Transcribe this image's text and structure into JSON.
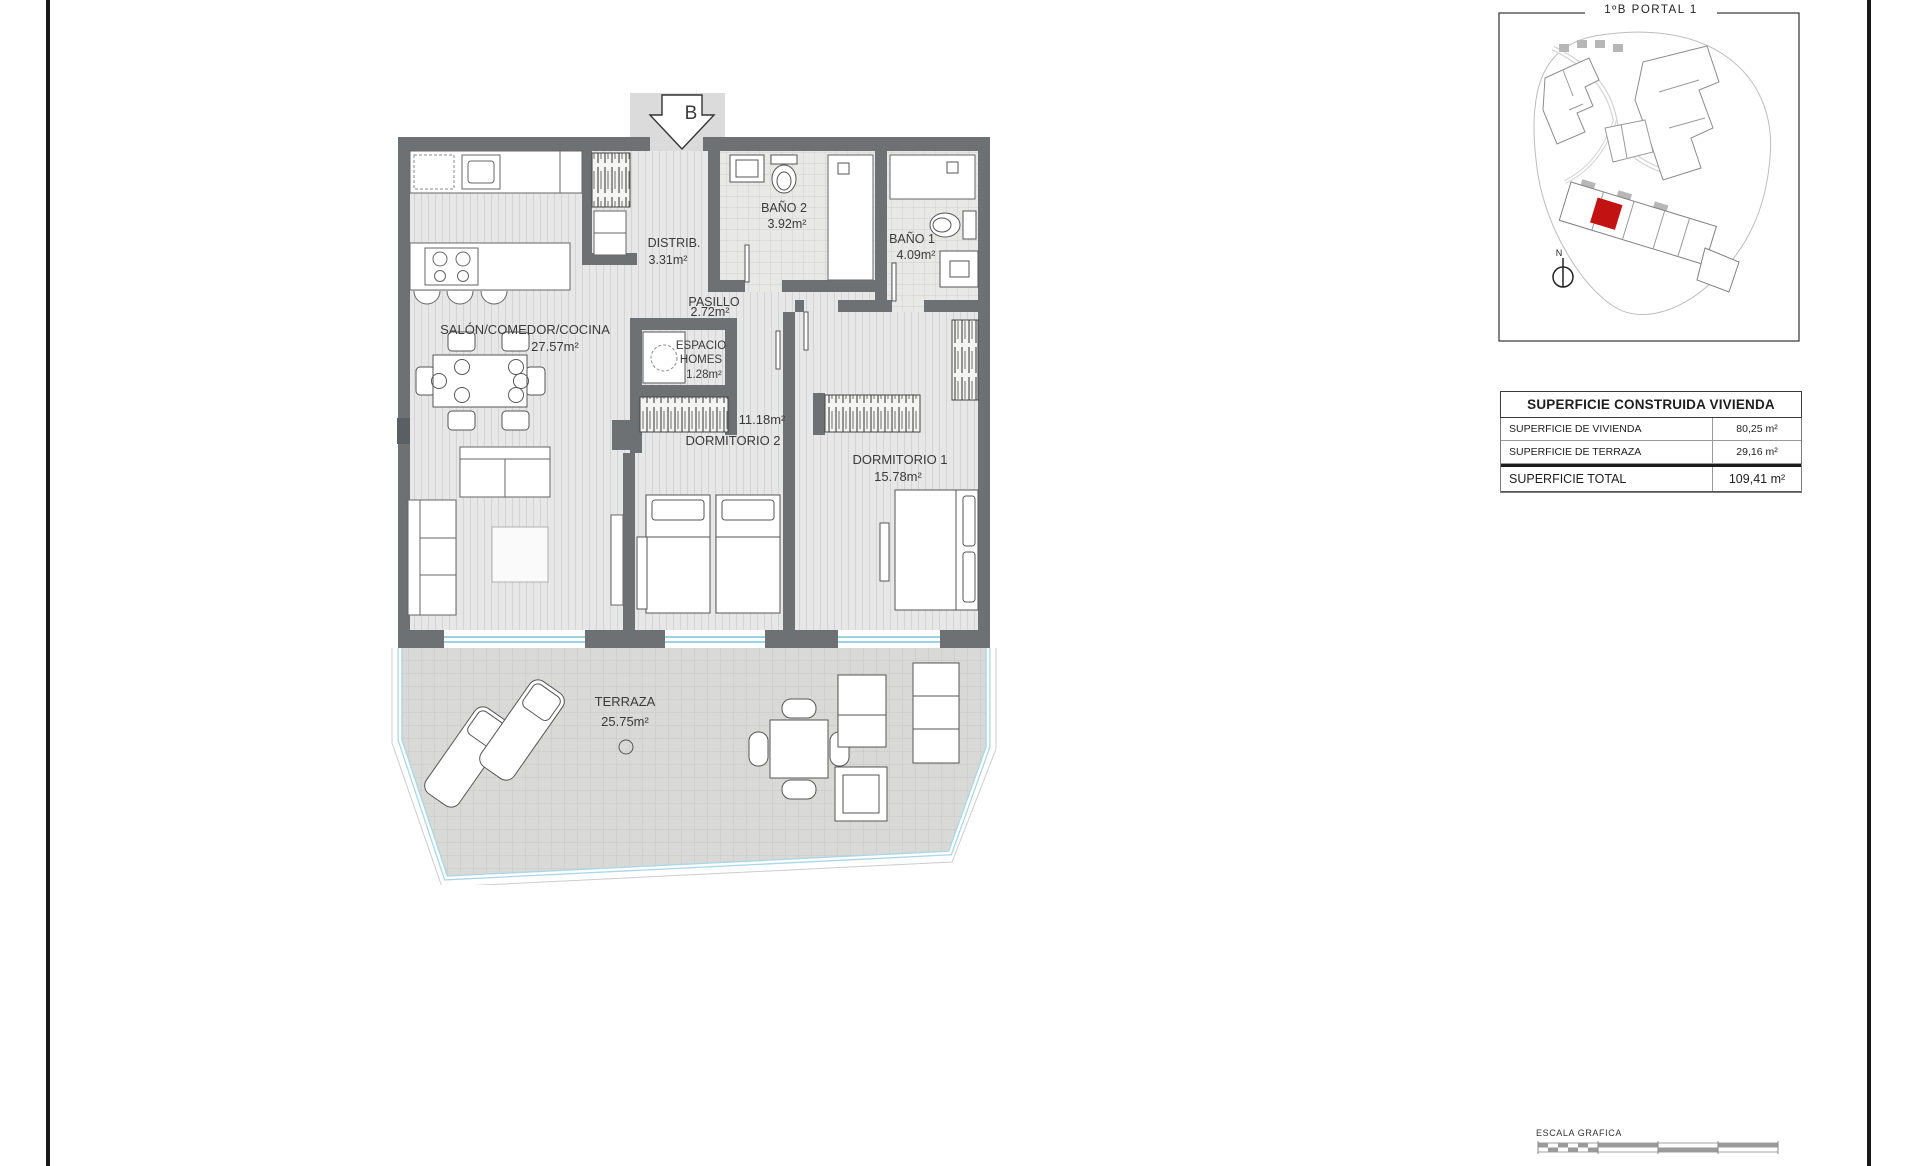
{
  "floor_plan": {
    "entrance_marker": "B",
    "rooms": {
      "salon": {
        "name": "SALÓN/COMEDOR/COCINA",
        "area": "27.57m²"
      },
      "distrib": {
        "name": "DISTRIB.",
        "area": "3.31m²"
      },
      "bano2": {
        "name": "BAÑO 2",
        "area": "3.92m²"
      },
      "bano1": {
        "name": "BAÑO 1",
        "area": "4.09m²"
      },
      "pasillo": {
        "name": "PASILLO",
        "area": "2.72m²"
      },
      "espacio_homes": {
        "line1": "ESPACIO",
        "line2": "HOMES",
        "area": "1.28m²"
      },
      "dormitorio2": {
        "name": "DORMITORIO 2",
        "area": "11.18m²"
      },
      "dormitorio1": {
        "name": "DORMITORIO 1",
        "area": "15.78m²"
      },
      "terraza": {
        "name": "TERRAZA",
        "area": "25.75m²"
      }
    }
  },
  "site_plan": {
    "title": "1ºB PORTAL 1",
    "north_label": "N",
    "highlight_color": "#c31212"
  },
  "area_table": {
    "header": "SUPERFICIE CONSTRUIDA VIVIENDA",
    "rows": [
      {
        "label": "SUPERFICIE DE VIVIENDA",
        "value": "80,25 m²"
      },
      {
        "label": "SUPERFICIE DE TERRAZA",
        "value": "29,16 m²"
      }
    ],
    "total_label": "SUPERFICIE TOTAL",
    "total_value": "109,41 m²"
  },
  "scale_bar": {
    "label": "ESCALA GRAFICA"
  },
  "colors": {
    "wall": "#6d7174",
    "glass_railing": "#7fc4d8",
    "site_highlight": "#c31212",
    "page_border": "#191919"
  }
}
